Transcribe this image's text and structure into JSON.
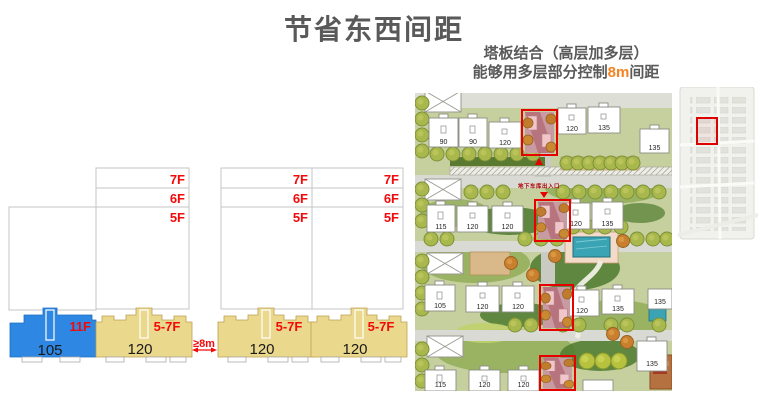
{
  "slide": {
    "title": "节省东西间距",
    "subtitle_line1": "塔板结合（高层加多层）",
    "subtitle_line2_pre": "能够用多层部分控制",
    "subtitle_line2_em": "8m",
    "subtitle_line2_post": "间距"
  },
  "colors": {
    "heading_gray": "#595959",
    "accent_orange": "#F5821F",
    "annotation_red": "#F20A0A",
    "tower_blue": "#2E87E2",
    "slab_yellow": "#EAD88D",
    "highlight_box_red": "#E60000"
  },
  "diagram": {
    "floor_labels": [
      "7F",
      "6F",
      "5F"
    ],
    "tower_floors": "11F",
    "tower_area": "105",
    "slab_floors": "5-7F",
    "slab_area": "120",
    "gap_label": "≥8m"
  },
  "siteplan": {
    "garage_label": "地下车库出入口",
    "building_labels": {
      "r1b1": "90",
      "r1b2": "90",
      "r1b3": "120",
      "r1b4": "120",
      "r1b5": "135",
      "r1b6": "135",
      "r2b1": "115",
      "r2b2": "120",
      "r2b3": "120",
      "r2b4": "120",
      "r2b5": "135",
      "r3b1": "105",
      "r3b2": "120",
      "r3b3": "120",
      "r3b4": "120",
      "r3b5": "135",
      "r3b6": "135",
      "r4b1": "115",
      "r4b2": "120",
      "r4b3": "120",
      "r4b4": "135"
    }
  }
}
